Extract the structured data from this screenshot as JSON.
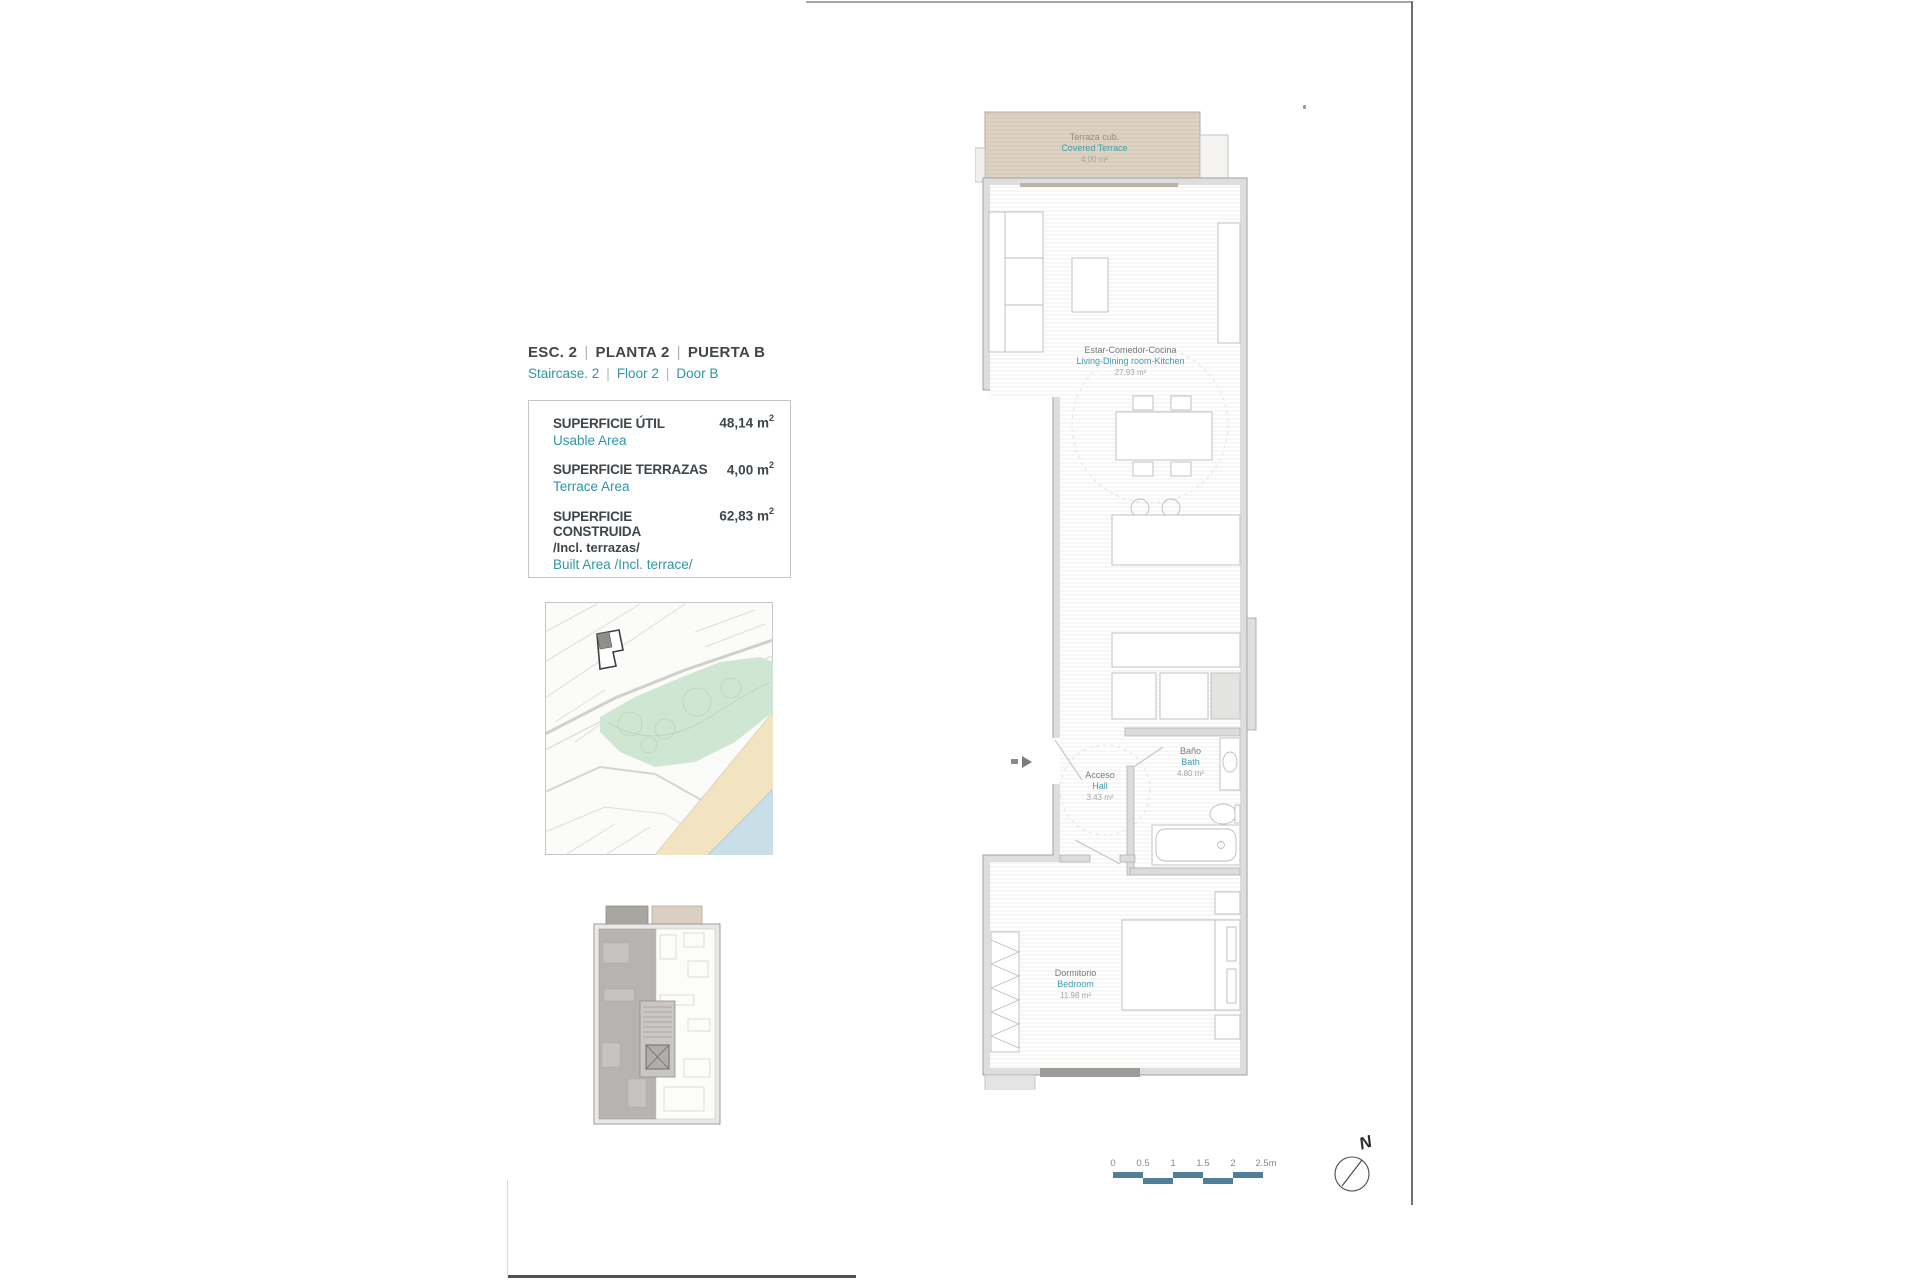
{
  "title_block": {
    "sep": "|",
    "row1": [
      "ESC. 2",
      "PLANTA 2",
      "PUERTA B"
    ],
    "row2": [
      "Staircase. 2",
      "Floor 2",
      "Door B"
    ]
  },
  "area_table": {
    "rows": [
      {
        "label": "SUPERFICIE ÚTIL",
        "label2": "",
        "sublabel": "Usable Area",
        "value": "48,14",
        "unit": "m",
        "sup": "2"
      },
      {
        "label": "SUPERFICIE TERRAZAS",
        "label2": "",
        "sublabel": "Terrace Area",
        "value": "4,00",
        "unit": "m",
        "sup": "2"
      },
      {
        "label": "SUPERFICIE CONSTRUIDA",
        "label2": "/Incl. terrazas/",
        "sublabel": "Built Area /Incl. terrace/",
        "value": "62,83",
        "unit": "m",
        "sup": "2"
      }
    ]
  },
  "plan": {
    "rooms": [
      {
        "name_es": "Terraza cub.",
        "name_en": "Covered Terrace",
        "area": "4.00 m²"
      },
      {
        "name_es": "Estar-Comedor-Cocina",
        "name_en": "Living-Dining room-Kitchen",
        "area": "27.93 m²"
      },
      {
        "name_es": "Baño",
        "name_en": "Bath",
        "area": "4.80 m²"
      },
      {
        "name_es": "Acceso",
        "name_en": "Hall",
        "area": "3.43 m²"
      },
      {
        "name_es": "Dormitorio",
        "name_en": "Bedroom",
        "area": "11.98 m²"
      }
    ]
  },
  "scale_bar": {
    "labels": [
      "0",
      "0.5",
      "1",
      "1.5",
      "2",
      "2.5m"
    ]
  },
  "compass": {
    "north_label": "N"
  },
  "colors": {
    "teal_accent": "#2e96a7",
    "dark_text": "#3e464b",
    "room_name_gray": "#75797c",
    "area_value_gray": "#a2a6a8",
    "wall_fill": "#dedede",
    "wall_stroke": "#a2a2a2",
    "terrace_fill": "#ded3c3",
    "scalebar_blue": "#4f7e98",
    "map_green": "#cfe7d2",
    "map_sand": "#f2e3c1",
    "map_sea": "#c8dfe7"
  }
}
